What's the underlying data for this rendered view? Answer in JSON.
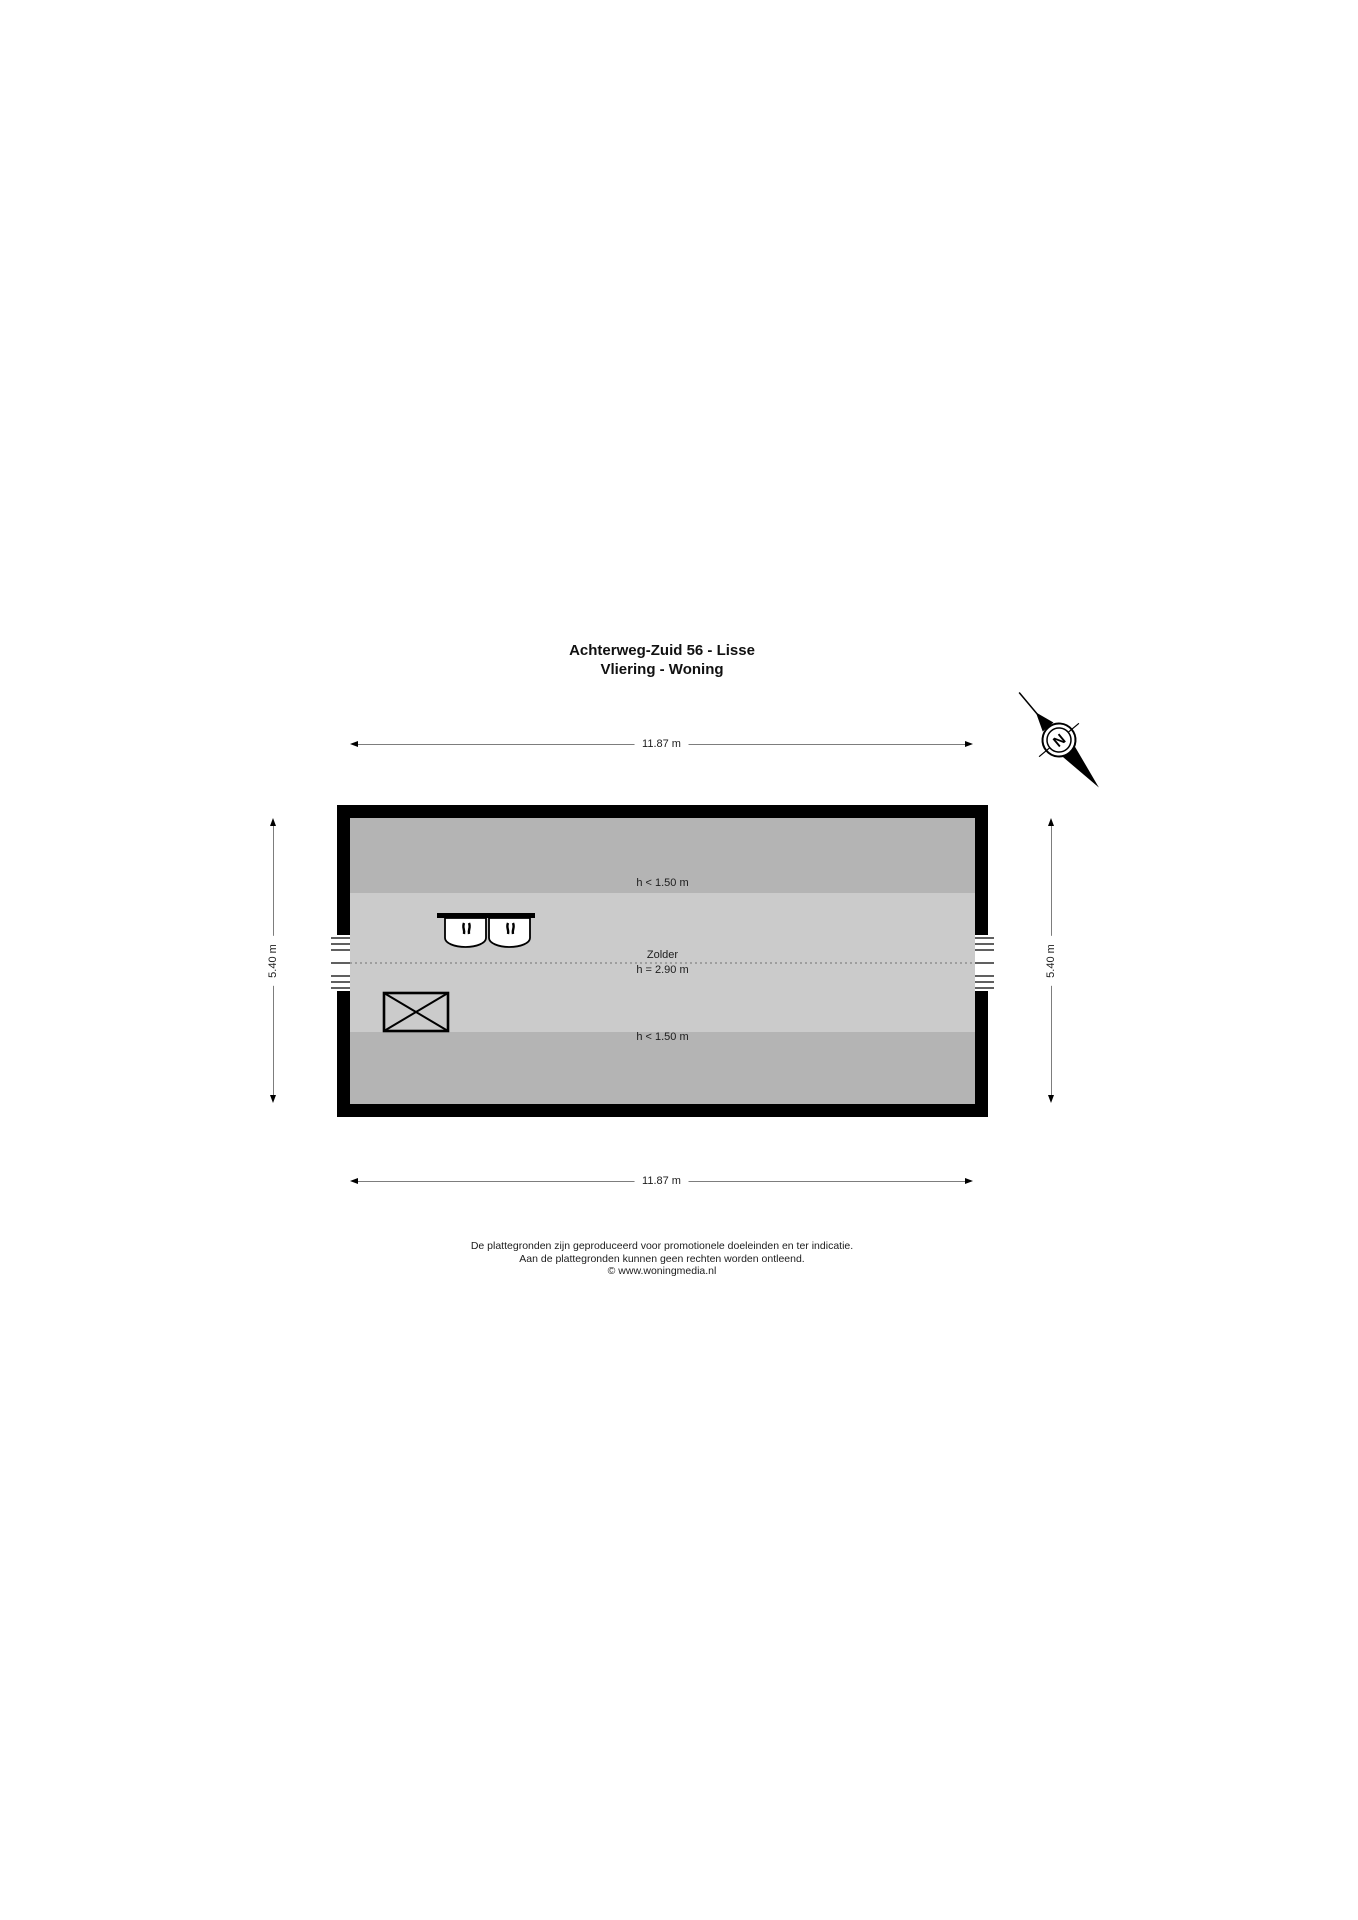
{
  "title": {
    "line1": "Achterweg-Zuid 56 - Lisse",
    "line2": "Vliering - Woning"
  },
  "compass": {
    "label": "N"
  },
  "dimensions": {
    "top": {
      "label": "11.87 m"
    },
    "bottom": {
      "label": "11.87 m"
    },
    "left": {
      "label": "5.40 m"
    },
    "right": {
      "label": "5.40 m"
    }
  },
  "plan": {
    "room_label": "Zolder",
    "ridge_height_label": "h = 2.90 m",
    "low_height_top_label": "h < 1.50 m",
    "low_height_bottom_label": "h < 1.50 m",
    "colors": {
      "wall": "#000000",
      "floor": "#cbcbcb",
      "low_headroom_zone": "#b4b4b4",
      "dimension_line": "#7d7d7d"
    }
  },
  "footer": {
    "line1": "De plattegronden zijn geproduceerd voor promotionele doeleinden en ter indicatie.",
    "line2": "Aan de plattegronden kunnen geen rechten worden ontleend.",
    "line3": "© www.woningmedia.nl"
  }
}
